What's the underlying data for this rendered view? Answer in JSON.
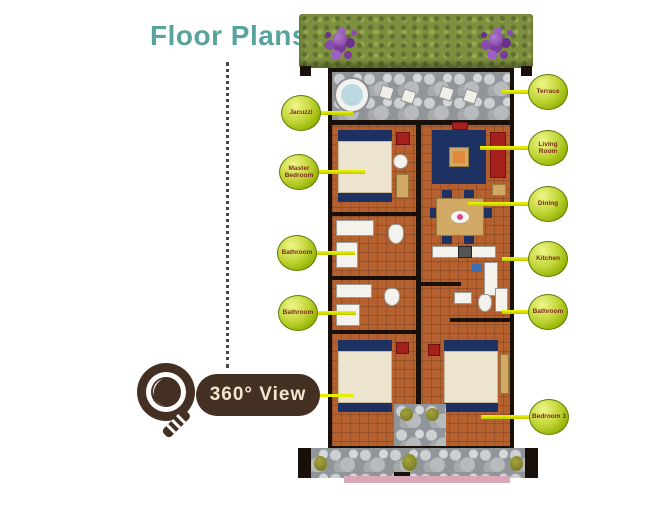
{
  "page": {
    "title": "Floor Plans"
  },
  "view_button": {
    "label": "360° View",
    "icon": "magnifier-icon"
  },
  "colors": {
    "title_teal": "#58a39b",
    "label_green": "#a8c400",
    "connector_yellow": "#e8ee00",
    "button_brown": "#443022",
    "button_text": "#f1e7cd",
    "floor_terracotta": "#b4602f",
    "wall_black": "#191009",
    "hedge_green": "#7d9040",
    "flower_purple": "#7b3a9c",
    "stone_gray": "#8f9598"
  },
  "labels": {
    "left": [
      {
        "text": "Jacuzzi"
      },
      {
        "text": "Master Bedroom"
      },
      {
        "text": "Bathroom"
      },
      {
        "text": "Bathroom"
      }
    ],
    "right": [
      {
        "text": "Terrace"
      },
      {
        "text": "Living Room"
      },
      {
        "text": "Dining"
      },
      {
        "text": "Kitchen"
      },
      {
        "text": "Bathroom"
      },
      {
        "text": "Bedroom 3"
      }
    ]
  }
}
